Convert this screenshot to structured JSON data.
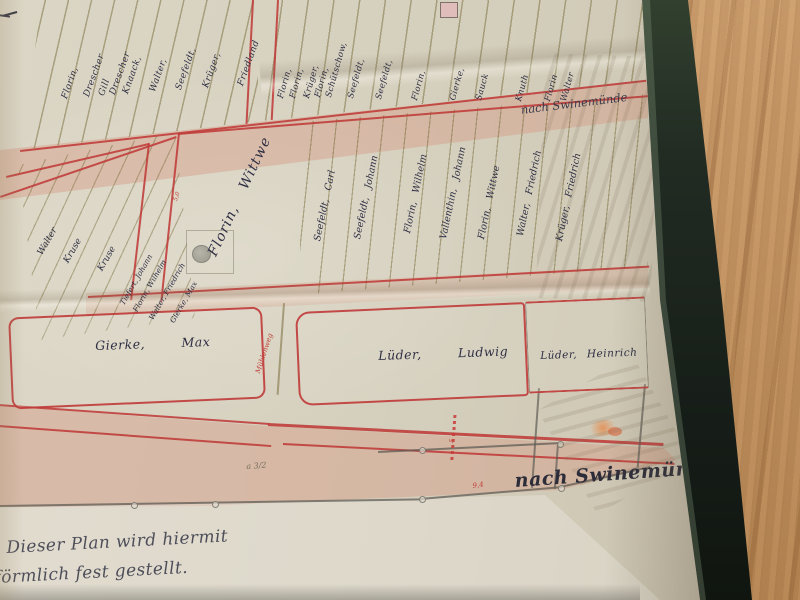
{
  "map": {
    "road_label_top": "nach Swinemünde",
    "road_label_bottom": "nach Swinemünde",
    "top_strips_left": [
      "Florin,",
      "Drescher",
      "Gill",
      "Drescher",
      "Knaack,",
      "Walter,",
      "Seefeldt,",
      "Krüger,",
      "Friedland"
    ],
    "top_strips_right": [
      "Florin,",
      "Florin,",
      "Krüger,",
      "Florin,",
      "Schütschow,",
      "Seefeldt,",
      "Seefeldt,",
      "Florin,",
      "Gierke,",
      "Sauck",
      "Knuth",
      "Florin",
      "Walter"
    ],
    "mid_strips_left": [
      "Walter",
      "Kruse",
      "Kruse",
      "Tiefert, Johann",
      "Florin, Wilhelm",
      "Walter, Friedrich",
      "Gierke, Max"
    ],
    "mid_parcel_main": "Florin, Wittwe",
    "mid_strips_right": [
      "Seefeldt, Carl",
      "Seefeldt, Johann",
      "Florin, Wilhelm",
      "Vallenthin, Johann",
      "Florin, Wittwe",
      "Walter, Friedrich",
      "Krüger, Friedrich"
    ],
    "lower_parcels": [
      "Gierke, Max",
      "Lüder, Ludwig",
      "Lüder, Heinrich"
    ],
    "annotations": {
      "red_path_label": "Mühlenweg",
      "red_measure_1": "5,0",
      "red_measure_2": "5",
      "red_measure_3": "9,4",
      "pencil_note": "a 3/2"
    },
    "inscription_line_1": "Dieser Plan wird hiermit",
    "inscription_line_2": "förmlich fest gestellt.",
    "colors": {
      "boundary_red": "#bf3a38",
      "ink_blue_black": "#2f2f44",
      "paper_beige": "#d6d0bf",
      "road_wash_pink": "#d9b5a6",
      "wood_tan": "#c79a69",
      "frame_dark_green": "#1f2822"
    }
  }
}
